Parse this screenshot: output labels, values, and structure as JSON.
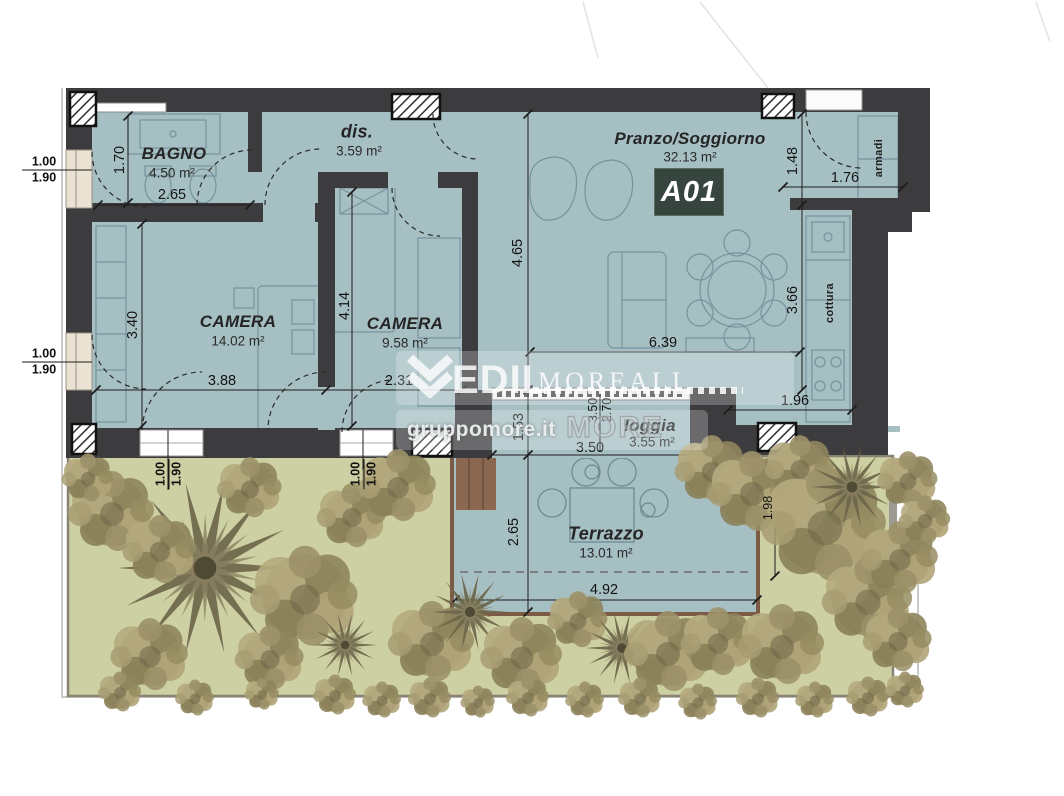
{
  "unit": {
    "code": "A01"
  },
  "rooms": {
    "bagno": {
      "name": "BAGNO",
      "area": "4.50 m²"
    },
    "dis": {
      "name": "dis.",
      "area": "3.59 m²"
    },
    "camera1": {
      "name": "CAMERA",
      "area": "14.02 m²"
    },
    "camera2": {
      "name": "CAMERA",
      "area": "9.58 m²"
    },
    "soggiorno": {
      "name": "Pranzo/Soggiorno",
      "area": "32.13 m²"
    },
    "loggia": {
      "name": "loggia",
      "area": "3.55 m²"
    },
    "terrazzo": {
      "name": "Terrazzo",
      "area": "13.01 m²"
    }
  },
  "fixtures": {
    "wardrobe": "armadi",
    "cooktop": "cottura"
  },
  "dims": {
    "bagno_h": "1.70",
    "bagno_w": "2.65",
    "cam1_h": "3.40",
    "cam1_w": "3.88",
    "cam2_h": "4.14",
    "cam2_w": "2.31",
    "sogg_h": "4.65",
    "sogg_w": "6.39",
    "kitchen_h": "3.66",
    "kitchen_w": "1.96",
    "entry_h": "1.48",
    "entry_w": "1.76",
    "loggia_h": "1.53",
    "loggia_glass_a": "3.50",
    "loggia_glass_b": "2.70",
    "loggia_w": "3.50",
    "terrazzo_h": "2.65",
    "terrazzo_w": "4.92",
    "garden_side": "1.98",
    "window_w": "1.00",
    "window_h": "1.90"
  },
  "watermark": {
    "brand_bold": "EDIL",
    "brand_serif": "MOREALI",
    "site": "gruppomore.it",
    "brand_outline": "MORE"
  },
  "colors": {
    "floor": "#a6bfc3",
    "wall": "#3c3c3e",
    "garden": "#cdd0a2",
    "badge": "#37453f",
    "terrace_border": "#7b5b45"
  }
}
